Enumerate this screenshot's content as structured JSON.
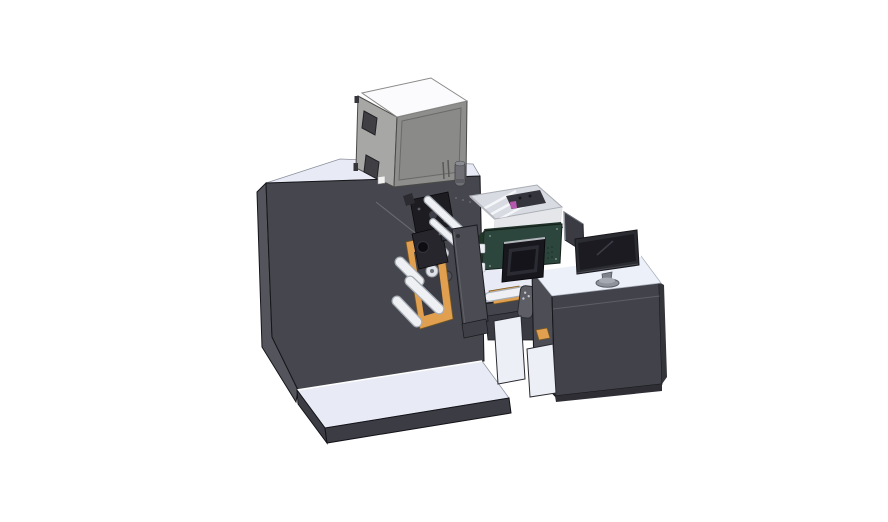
{
  "scene": {
    "description": "Isometric 3D CAD render of an industrial label printing line: dark main cabinet with roller/unwind mechanism and gray enclosure box on top, central inkjet module with small control display inside an open-top transparent housing, handheld pendant control, and an operator desk with a flat monitor on a stand; machine and desk sit on light base platforms over a white background",
    "parts": [
      "main-cabinet",
      "cabinet-top-surface",
      "base-platform",
      "top-enclosure-box",
      "enclosure-windows",
      "exhaust-cylinder",
      "printhead-assembly",
      "unwind-orange-plate",
      "guide-rollers",
      "front-swing-panel",
      "open-top-housing",
      "ink-module",
      "control-display",
      "handheld-remote",
      "middle-counter",
      "interior-shelf-panels",
      "operator-desk",
      "desk-open-shelf",
      "desk-monitor",
      "monitor-side-panel",
      "monitor-stand"
    ]
  },
  "colors": {
    "background": "#ffffff",
    "machine-front": "#46464e",
    "machine-side": "#54545c",
    "surface-light": "#e8ebf5",
    "platform-front": "#3c3c44",
    "box-left": "#a7a7a5",
    "box-front": "#8e8e8c",
    "box-top": "#fbfbfd",
    "window-dark": "#3f3f44",
    "orange": "#e0a04f",
    "roller-white": "#eef0f4",
    "roller-edge": "#a6acb4",
    "black-part": "#1c1c21",
    "panel-gray": "#4b4b54",
    "openbox-interior": "#d8dbe1",
    "magenta": "#b659ae",
    "green-module": "#2d463d",
    "screen-dark": "#14141a",
    "desk-front": "#42424b",
    "desk-side": "#4d4d56",
    "desk-top": "#ecf0f8",
    "interior-white": "#edeff6",
    "remote-gray": "#5e5e66",
    "monitor-frame": "#2b2b32",
    "monitor-screen": "#1b1b21",
    "stand-gray": "#8e929b"
  }
}
